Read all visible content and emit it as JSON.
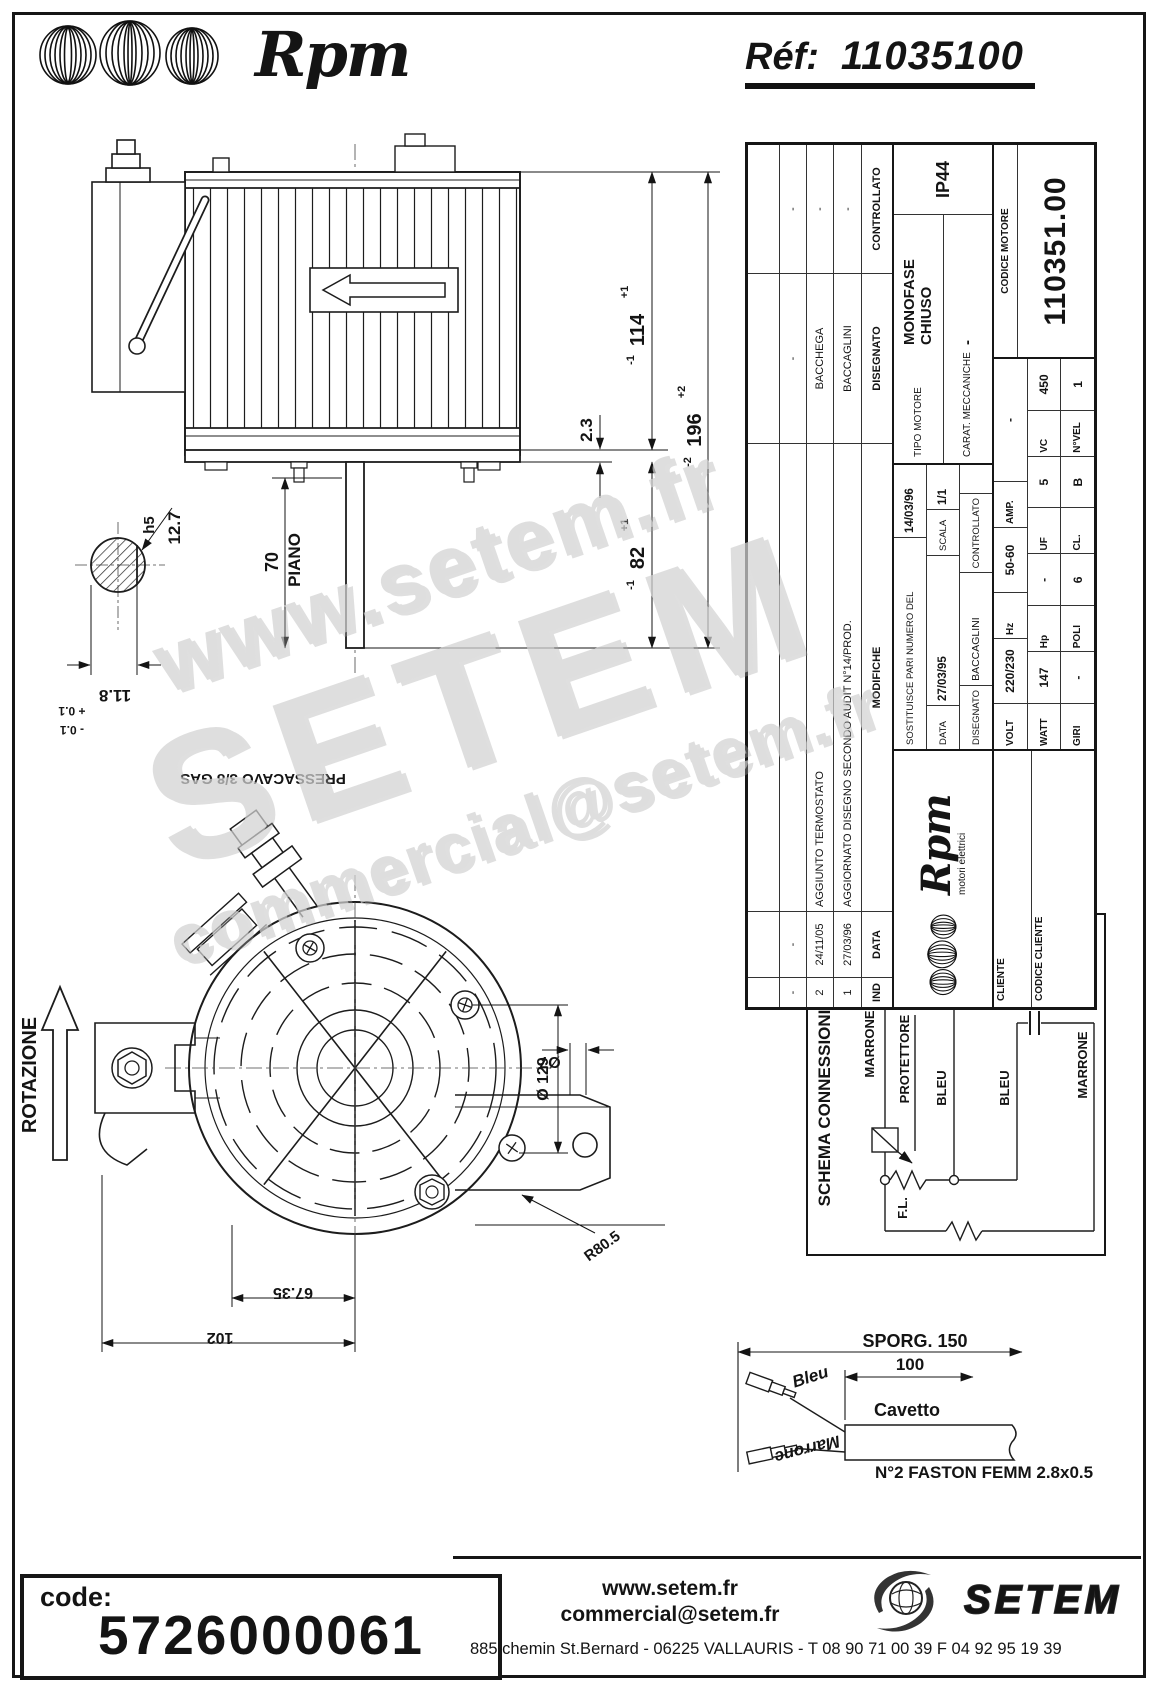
{
  "header": {
    "brand": "Rpm",
    "ref_label": "Réf:",
    "ref_value": "11035100"
  },
  "watermark": {
    "line1": "www.setem.fr",
    "line2": "SETEM",
    "line3": "commercial@setem.fr"
  },
  "side_view": {
    "dims": {
      "d114": "114",
      "d114_plus": "+1",
      "d114_minus": "-1",
      "d196": "196",
      "d196_plus": "+2",
      "d196_minus": "-2",
      "d82": "82",
      "d82_plus": "+1",
      "d82_minus": "-1",
      "d23": "2.3",
      "d70": "70",
      "piano": "PIANO",
      "d127": "12.7",
      "h5": "h5",
      "d118": "11.8",
      "d118_plus": "+ 0.1",
      "d118_minus": "- 0.1"
    }
  },
  "front_view": {
    "rotation_label": "ROTAZIONE",
    "pressacavo": "PRESSACAVO 3/8 GAS",
    "dia7": "Ø7",
    "dia129": "Ø 129",
    "r805": "R80.5",
    "d6735": "67.35",
    "d102": "102"
  },
  "schema": {
    "title": "SCHEMA CONNESSIONI",
    "linea": "LINEA",
    "marrone_left": "MARRONE",
    "protettore": "PROTETTORE",
    "bleu_1": "BLEU",
    "bleu_2": "BLEU",
    "marrone_right": "MARRONE",
    "fl": "F.L."
  },
  "cable": {
    "sporg": "SPORG. 150",
    "d100": "100",
    "cavetto": "Cavetto",
    "bleu": "Bleu",
    "marrone": "Marrone",
    "faston": "N°2 FASTON FEMM 2.8x0.5"
  },
  "title_block": {
    "headers": {
      "ind": "IND",
      "data": "DATA",
      "modifiche": "MODIFICHE",
      "disegnato": "DISEGNATO",
      "controllato": "CONTROLLATO"
    },
    "revisions": [
      {
        "ind": "-",
        "date": "-",
        "mod": "",
        "dis": "-",
        "con": "-"
      },
      {
        "ind": "2",
        "date": "24/11/05",
        "mod": "AGGIUNTO TERMOSTATO",
        "dis": "BACCHEGA",
        "con": "-"
      },
      {
        "ind": "1",
        "date": "27/03/96",
        "mod": "AGGIORNATO DISEGNO SECONDO AUDIT N°14/PROD.",
        "dis": "BACCAGLINI",
        "con": "-"
      }
    ],
    "brand": "Rpm",
    "brand_sub": "motori elettrici",
    "sostituisce_label": "SOSTITUISCE PARI NUMERO DEL",
    "sostituisce_value": "14/03/96",
    "data_label": "DATA",
    "data_value": "27/03/95",
    "scala_label": "SCALA",
    "scala_value": "1/1",
    "disegnato_label": "DISEGNATO",
    "disegnato_value": "BACCAGLINI",
    "controllato_label": "CONTROLLATO",
    "controllato_value": "",
    "tipo_label": "TIPO MOTORE",
    "tipo_value": "MONOFASE CHIUSO",
    "carat_label": "CARAT. MECCANICHE",
    "carat_value": "-",
    "protezione": "IP44",
    "elec": {
      "volt_l": "VOLT",
      "volt": "220/230",
      "hz_l": "Hz",
      "hz": "50-60",
      "amp_l": "AMP.",
      "amp": "-",
      "watt_l": "WATT",
      "watt": "147",
      "hp_l": "Hp",
      "hp": "-",
      "uf_l": "UF",
      "uf": "5",
      "vc_l": "VC",
      "vc": "450",
      "giri_l": "GIRI",
      "giri": "-",
      "poli_l": "POLI",
      "poli": "6",
      "cl_l": "CL.",
      "cl": "B",
      "nvel_l": "N°VEL",
      "nvel": "1"
    },
    "cliente_label": "CLIENTE",
    "codice_cliente_label": "CODICE CLIENTE",
    "codice_motore_label": "CODICE MOTORE",
    "codice_motore_value": "110351.00"
  },
  "footer": {
    "code_label": "code:",
    "code_value": "5726000061",
    "website": "www.setem.fr",
    "email": "commercial@setem.fr",
    "brand": "SETEM",
    "address": "885 chemin St.Bernard  -  06225 VALLAURIS  -  T 08 90 71 00 39   F 04 92 95 19 39"
  }
}
